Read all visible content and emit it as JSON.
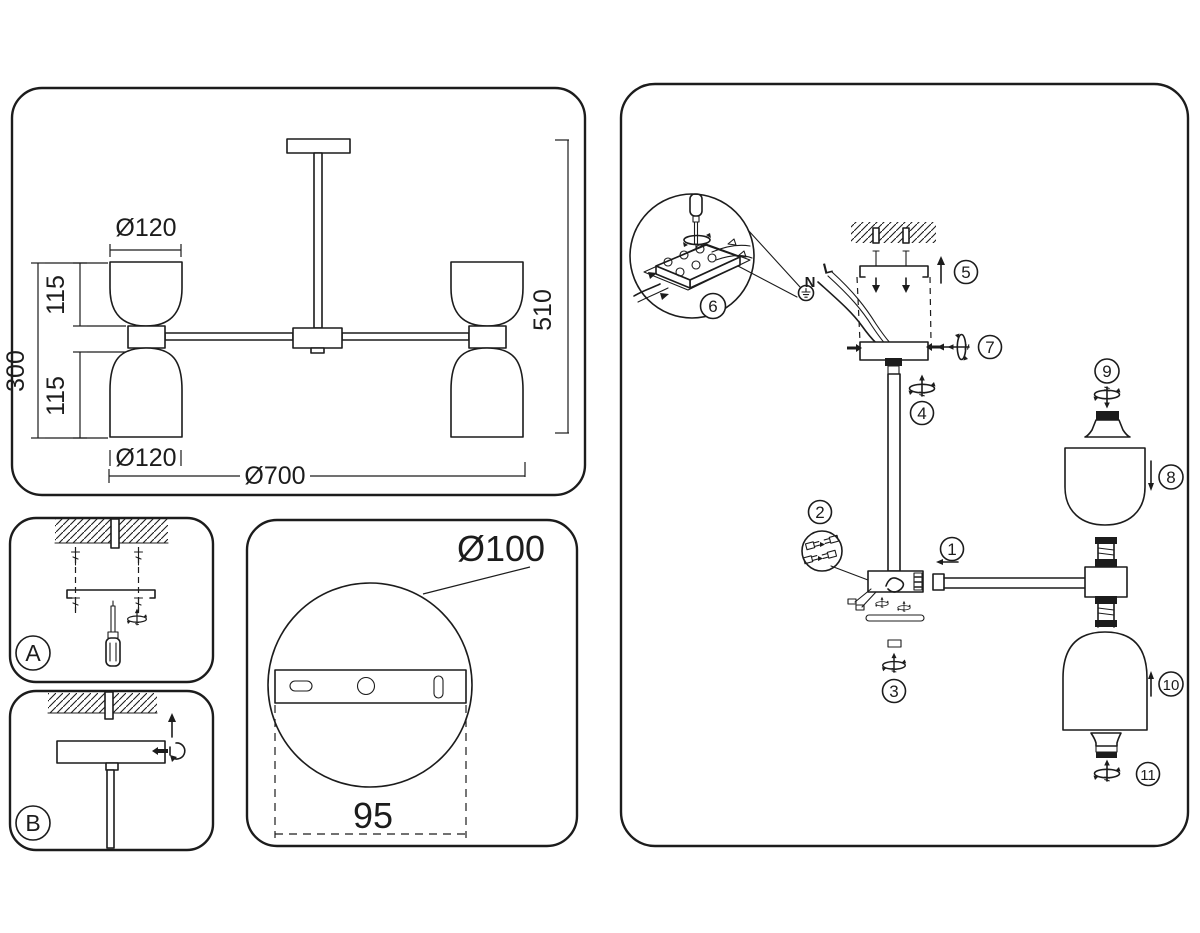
{
  "colors": {
    "ink": "#1c1c1c",
    "paper": "#ffffff"
  },
  "overview_panel": {
    "top_shade_diameter": "Ø120",
    "upper_shade_height": "115",
    "body_height": "300",
    "lower_shade_height": "115",
    "bottom_shade_diameter": "Ø120",
    "overall_width": "Ø700",
    "overall_height": "510"
  },
  "mount_detail_panel": {
    "plate_diameter": "Ø100",
    "hole_spacing": "95"
  },
  "step_panels": {
    "step_a_label": "A",
    "step_b_label": "B"
  },
  "wiring": {
    "neutral_label": "N",
    "live_label": "L"
  },
  "assembly_panel": {
    "parts": {
      "p1": "1",
      "p2": "2",
      "p3": "3",
      "p4": "4",
      "p5": "5",
      "p6": "6",
      "p7": "7",
      "p8": "8",
      "p9": "9",
      "p10": "10",
      "p11": "11"
    }
  }
}
